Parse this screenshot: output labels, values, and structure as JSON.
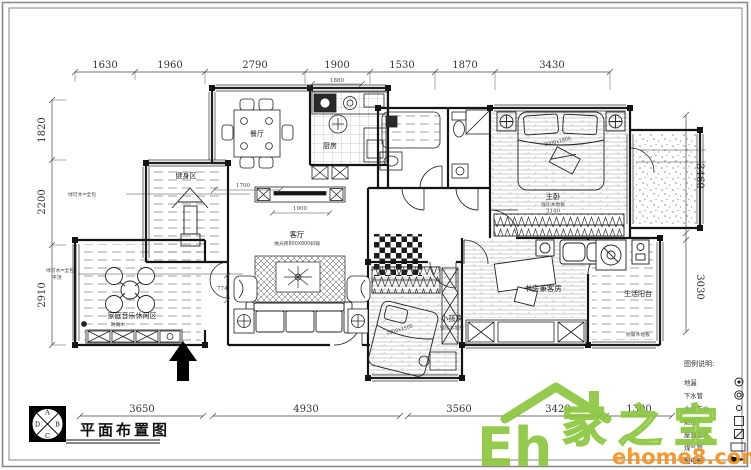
{
  "title_block": {
    "title": "平面布置图",
    "compass_a": "A",
    "compass_b": "B",
    "compass_c": "C",
    "compass_d": "D"
  },
  "dims": {
    "top": [
      "1630",
      "1960",
      "2790",
      "1900",
      "1530",
      "1870",
      "3430"
    ],
    "left": [
      "1820",
      "2200",
      "2910"
    ],
    "right": [
      "3460",
      "3030"
    ],
    "bottom": [
      "3650",
      "4930",
      "3560",
      "3420",
      "1300"
    ],
    "inner": {
      "d1880": "1880",
      "d1700": "1700",
      "d774": "774",
      "d1900": "1900",
      "d3140": "3140"
    }
  },
  "rooms": {
    "dining": "餐厅",
    "kitchen": "厨房",
    "living": "客厅",
    "living_floor": "抛光砖800X800斜铺",
    "master": "主卧",
    "master_floor": "强化木地板",
    "kids": "小孩房",
    "kids_floor": "强化木地板",
    "study": "书房兼客房",
    "utility": "生活阳台",
    "utility_floor": "防腐木地板",
    "fitness": "健身区",
    "leisure": "家庭音乐休闲区",
    "leisure_floor": "防腐木"
  },
  "furniture": {
    "bed_master": "2000x1800",
    "bed_kids": "2000x1500"
  },
  "annotations": {
    "fitness_note": "绿可木=全包",
    "leisure_note1": "绿可木=全包",
    "leisure_note2": "平顶"
  },
  "legend": {
    "title": "图例说明:",
    "items": [
      "地漏",
      "下水管",
      "水盆下水",
      "烟道",
      "屋面落水",
      "煤气管",
      "配电箱"
    ]
  },
  "watermark": {
    "eh": "Eh",
    "brand": "家之宝",
    "url": "ehome8.com",
    "green": "#8cc63e",
    "orange": "#f6921e"
  }
}
